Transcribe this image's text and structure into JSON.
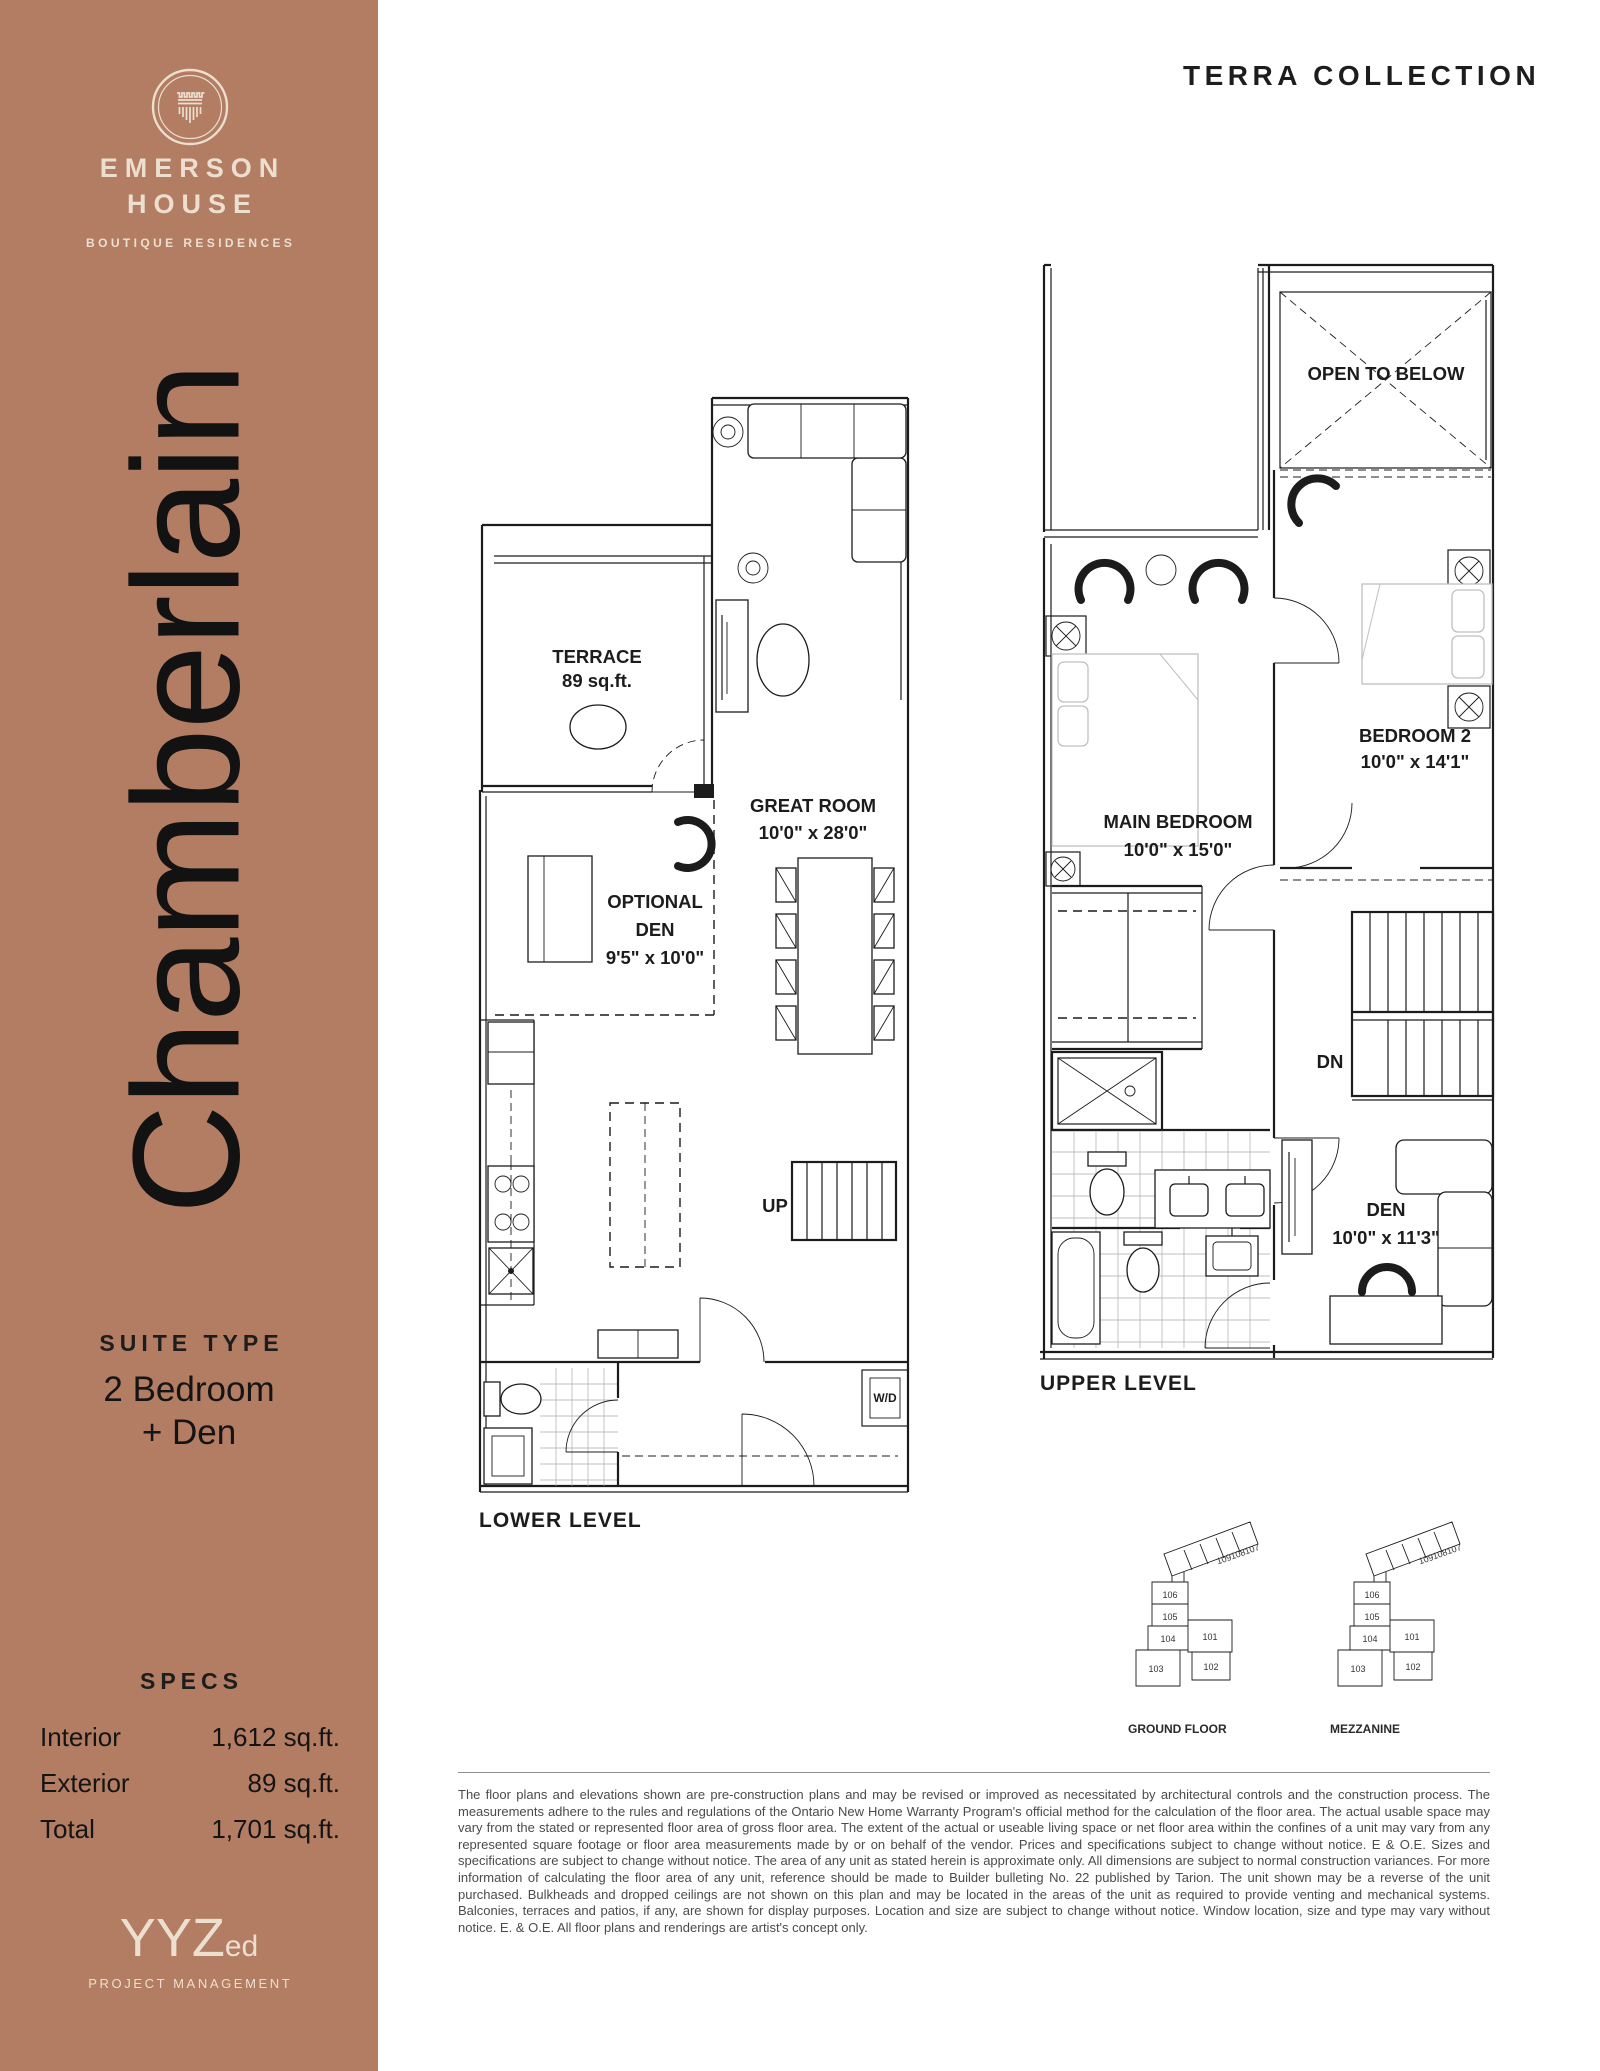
{
  "collection": "TERRA COLLECTION",
  "brand": {
    "line1": "EMERSON",
    "line2": "HOUSE",
    "tagline": "BOUTIQUE RESIDENCES"
  },
  "suite": {
    "name": "Chamberlain",
    "type_label": "SUITE TYPE",
    "type_line1": "2 Bedroom",
    "type_line2": "+ Den"
  },
  "specs": {
    "title": "SPECS",
    "rows": [
      {
        "label": "Interior",
        "value": "1,612 sq.ft."
      },
      {
        "label": "Exterior",
        "value": "89 sq.ft."
      },
      {
        "label": "Total",
        "value": "1,701 sq.ft."
      }
    ]
  },
  "plans": {
    "lower": {
      "title": "LOWER LEVEL",
      "terrace_1": "TERRACE",
      "terrace_2": "89 sq.ft.",
      "great_room_1": "GREAT ROOM",
      "great_room_2": "10'0\" x 28'0\"",
      "den_1": "OPTIONAL",
      "den_2": "DEN",
      "den_3": "9'5\" x 10'0\"",
      "up": "UP",
      "wd": "W/D"
    },
    "upper": {
      "title": "UPPER LEVEL",
      "open_below": "OPEN TO BELOW",
      "bedroom2_1": "BEDROOM 2",
      "bedroom2_2": "10'0\" x 14'1\"",
      "main_1": "MAIN BEDROOM",
      "main_2": "10'0\" x 15'0\"",
      "dn": "DN",
      "den_1": "DEN",
      "den_2": "10'0\" x 11'3\""
    }
  },
  "keyplans": [
    {
      "label": "GROUND FLOOR",
      "units": [
        "106",
        "105",
        "104",
        "103",
        "102",
        "101",
        "109",
        "108",
        "107"
      ]
    },
    {
      "label": "MEZZANINE",
      "units": [
        "106",
        "105",
        "104",
        "103",
        "102",
        "101",
        "109",
        "108",
        "107"
      ]
    }
  ],
  "footer_logo": {
    "main": "YYZ",
    "sub": "ed",
    "tagline": "PROJECT MANAGEMENT"
  },
  "disclaimer": "The floor plans and elevations shown are pre-construction plans and may be revised or improved as necessitated by architectural controls and the construction process. The measurements adhere to the rules and regulations of the Ontario New Home Warranty Program's official method for the calculation of the floor area. The actual usable space may vary from the stated or represented floor area of gross floor area. The extent of the actual or useable living space or net floor area within the confines of a unit may vary from any represented square footage or floor area measurements made by or on behalf of the vendor. Prices and specifications subject to change without notice. E & O.E. Sizes and specifications are subject to change without notice. The area of any unit as stated herein is approximate only. All dimensions are subject to normal construction variances. For more information of calculating the floor area of any unit, reference should be made to Builder bulleting No. 22 published by Tarion. The unit shown may be a reverse of the unit purchased. Bulkheads and dropped ceilings are not shown on this plan and may be located in the areas of the unit as required to provide venting and mechanical systems. Balconies, terraces and patios, if any, are shown for display purposes. Location and size are subject to change without notice. Window location, size and type may vary without notice. E. & O.E. All floor plans and renderings are artist's concept only.",
  "colors": {
    "sidebar": "#b27d63",
    "cream": "#ecdfd0",
    "ink": "#1c1c1c",
    "text_gray": "#4b4b4b"
  }
}
